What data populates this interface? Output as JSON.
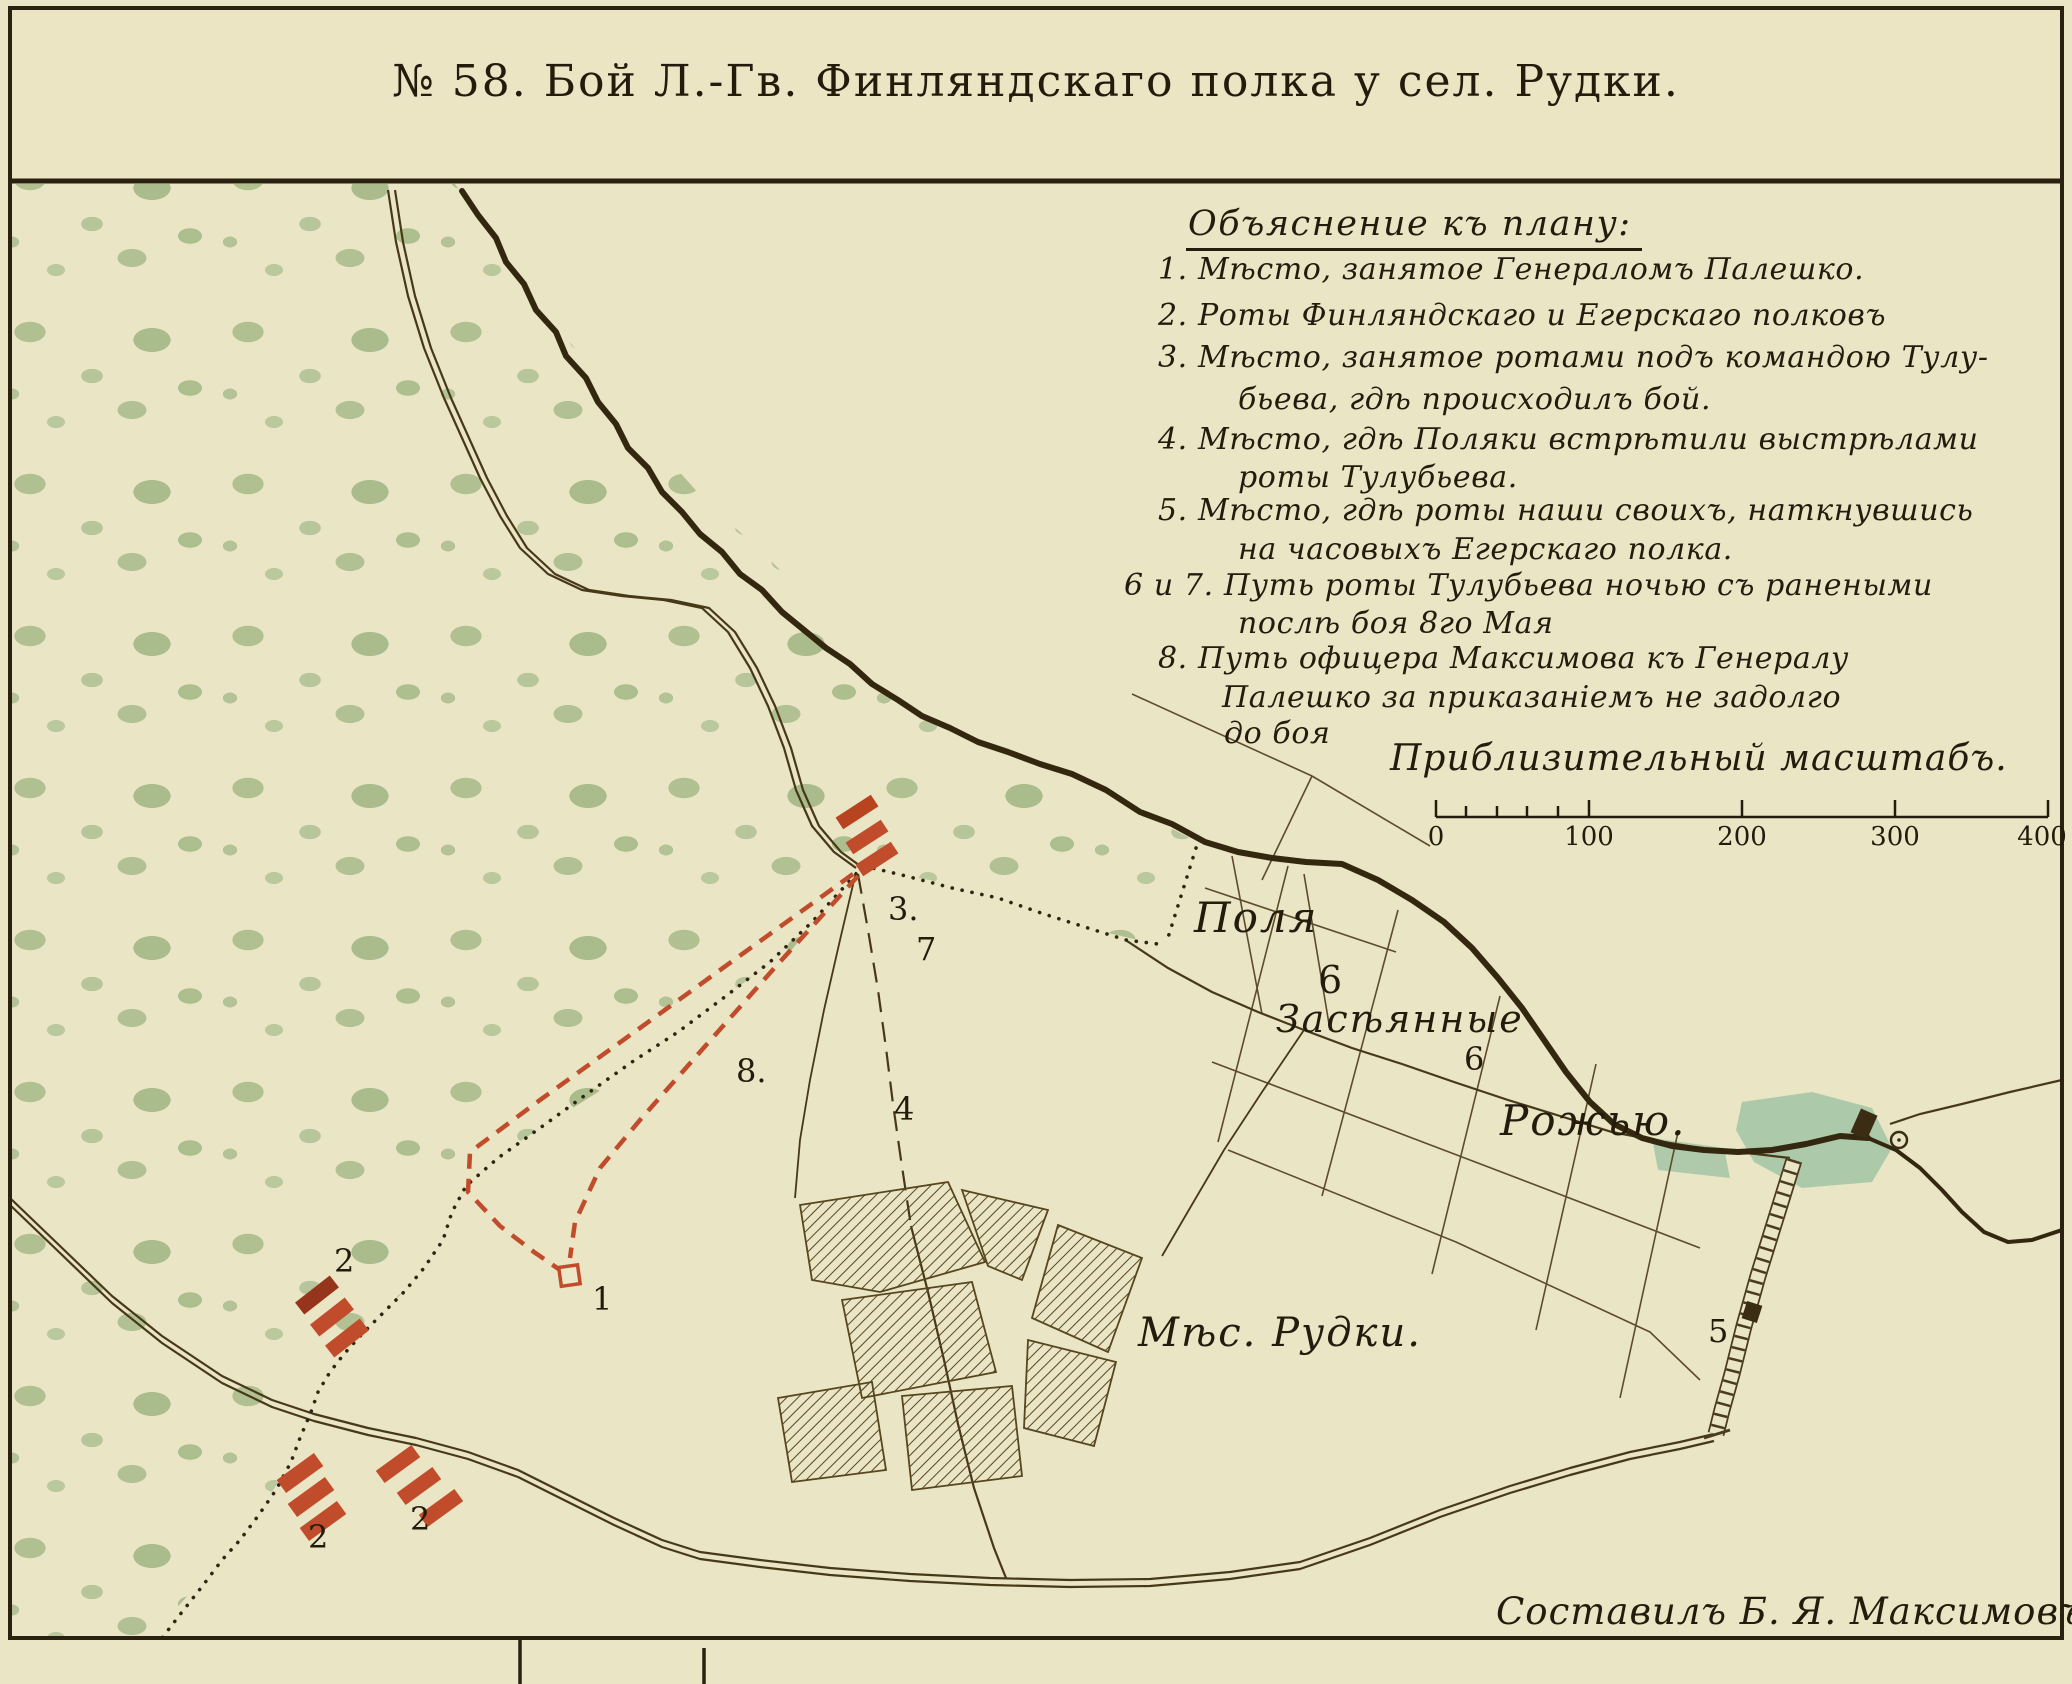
{
  "title": "№ 58. Бой Л.-Гв. Финляндскаго полка у сел. Рудки.",
  "legend": {
    "heading": "Объяснение къ плану:",
    "lines": [
      "1. Мѣсто, занятое Генераломъ Палешко.",
      "2. Роты Финляндскаго и Егерскаго полковъ",
      "3. Мѣсто, занятое ротами подъ командою Тулу-",
      "бьева, гдѣ происходилъ бой.",
      "4. Мѣсто, гдѣ Поляки встрѣтили выстрѣлами",
      "роты Тулубьева.",
      "5. Мѣсто, гдѣ роты наши своихъ, наткнувшись",
      "на часовыхъ Егерскаго полка.",
      "6 и 7. Путь роты Тулубьева ночью съ ранеными",
      "послѣ боя 8го Мая",
      "8. Путь офицера Максимова къ Генералу",
      "Палешко за приказаніемъ не задолго",
      "до боя"
    ]
  },
  "scale": {
    "caption": "Приблизительный масштабъ.",
    "ticks": [
      "0",
      "100",
      "200",
      "300",
      "400"
    ]
  },
  "map_labels": {
    "polya": "Поля",
    "zaseyannye": "Засѣянные",
    "rozhyu": "Рожью.",
    "village": "Мѣс. Рудки.",
    "n1": "1",
    "n2": "2",
    "n3": "3.",
    "n4": "4",
    "n5": "5",
    "n6": "6",
    "n7": "7",
    "n8": "8."
  },
  "signature": "Составилъ Б. Я. Максимовъ.",
  "colors": {
    "paper": "#e9e5c5",
    "forest_green": "#b0c091",
    "river_brown": "#33270f",
    "road_brown": "#473818",
    "marker_red": "#c14c2b",
    "pond_green": "#a5c6a5",
    "ink": "#241b0d"
  }
}
